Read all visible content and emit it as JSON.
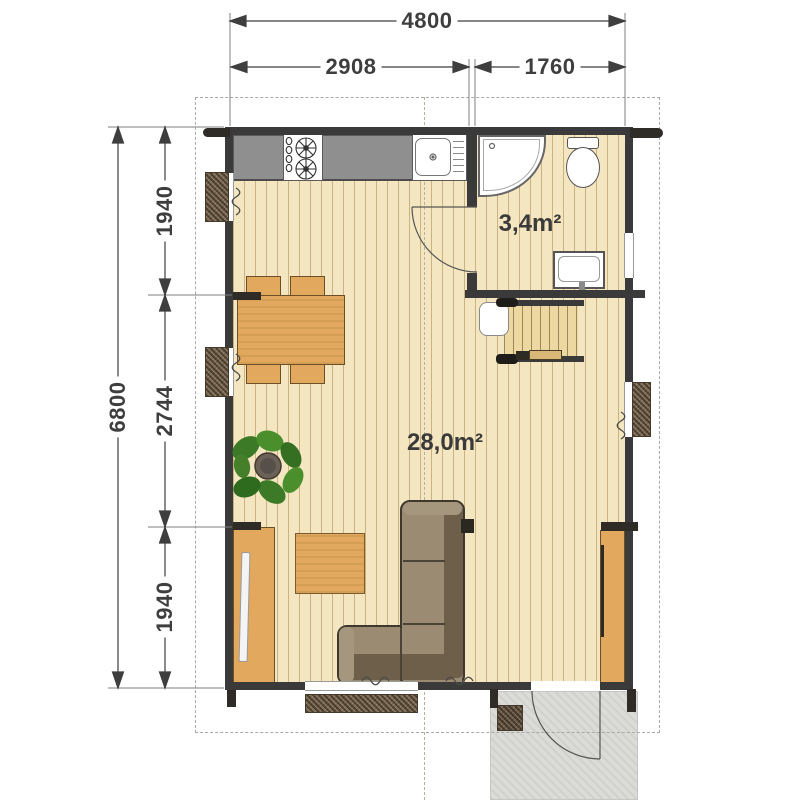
{
  "dimensions": {
    "top_total": "4800",
    "top_segment_left": "2908",
    "top_segment_right": "1760",
    "side_total": "6800",
    "side_segments": [
      "1940",
      "2744",
      "1940"
    ]
  },
  "rooms": {
    "bathroom_area": "3,4m²",
    "living_area": "28,0m²"
  },
  "fixtures": [
    "kitchen-counter",
    "stove",
    "kitchen-sink",
    "corner-shower",
    "toilet",
    "washbasin",
    "staircase",
    "appliance",
    "dining-table",
    "chairs",
    "potted-plant",
    "tv-wardrobe",
    "coffee-table",
    "corner-sofa",
    "tall-cabinet",
    "entrance-door",
    "interior-door",
    "porch",
    "doormat",
    "windows"
  ],
  "colors": {
    "wall": "#3a3a3a",
    "floor": "#f4e6c0",
    "floor_stripe": "#c8ab74",
    "counter": "#8f8f8f",
    "furniture_wood": "#e2a95e",
    "sofa_seat": "#9a8b72",
    "sofa_back": "#6e5f4b",
    "window_shutter": "#7b6952",
    "porch": "#dbdbd8",
    "plant_green": "#3f7d2e",
    "dimension_text": "#3e3e3e"
  }
}
